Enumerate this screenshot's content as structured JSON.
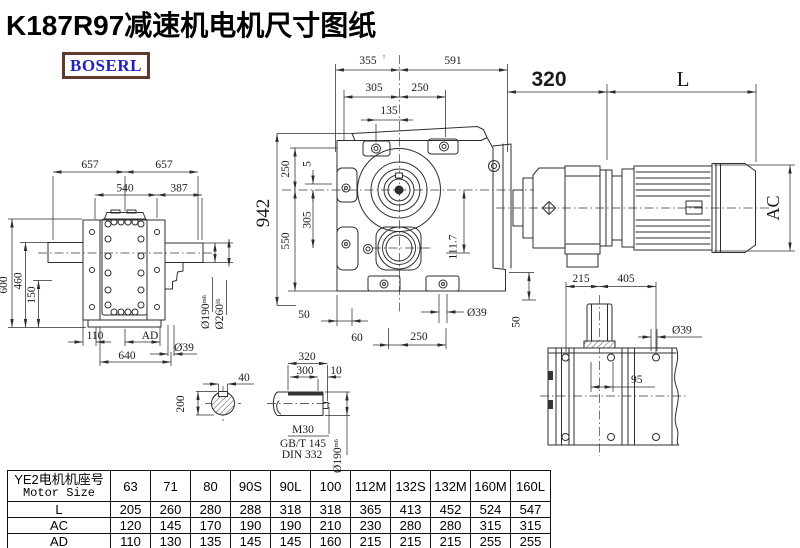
{
  "title": "K187R97减速机电机尺寸图纸",
  "logo": "BOSERL",
  "colors": {
    "line": "#2e2e2e",
    "title": "#000000",
    "logo_text": "#2121c0",
    "logo_border": "#5c3a30"
  },
  "dims": {
    "side": {
      "w1": "657",
      "w2": "657",
      "w3": "540",
      "w4": "387",
      "h1": "600",
      "h2": "460",
      "h3": "150",
      "b1": "110",
      "b2": "AD",
      "b3": "640",
      "b4": "Ø39",
      "d1": "Ø190",
      "d1s": "m6",
      "d2": "Ø260",
      "d2s": "f6"
    },
    "front": {
      "t1": "355",
      "t1s": "↑",
      "t2": "591",
      "t3": "305",
      "t4": "250",
      "t5": "135",
      "l1": "250",
      "l2": "5",
      "l3": "550",
      "l4": "305",
      "l5": "942",
      "r1": "111.7",
      "r2": "50",
      "b1": "50",
      "b2": "60",
      "b3": "250",
      "b4": "Ø39"
    },
    "motor": {
      "d1": "320",
      "d2": "L",
      "d3": "AC"
    },
    "top": {
      "d1": "215",
      "d2": "405",
      "d3": "Ø39",
      "d4": "95"
    },
    "shaft": {
      "d1": "40",
      "d2": "200",
      "d3": "320",
      "d4": "300",
      "d5": "10",
      "d6": "M30",
      "d7": "GB/T 145",
      "d8": "DIN 332",
      "d9": "Ø190",
      "d9s": "m6"
    }
  },
  "table": {
    "header_cn": "YE2电机机座号",
    "header_en": "Motor Size",
    "columns": [
      "63",
      "71",
      "80",
      "90S",
      "90L",
      "100",
      "112M",
      "132S",
      "132M",
      "160M",
      "160L"
    ],
    "rows": [
      {
        "label": "L",
        "values": [
          "205",
          "260",
          "280",
          "288",
          "318",
          "318",
          "365",
          "413",
          "452",
          "524",
          "547"
        ]
      },
      {
        "label": "AC",
        "values": [
          "120",
          "145",
          "170",
          "190",
          "190",
          "210",
          "230",
          "280",
          "280",
          "315",
          "315"
        ]
      },
      {
        "label": "AD",
        "values": [
          "110",
          "130",
          "135",
          "145",
          "145",
          "160",
          "215",
          "215",
          "215",
          "255",
          "255"
        ]
      }
    ]
  }
}
